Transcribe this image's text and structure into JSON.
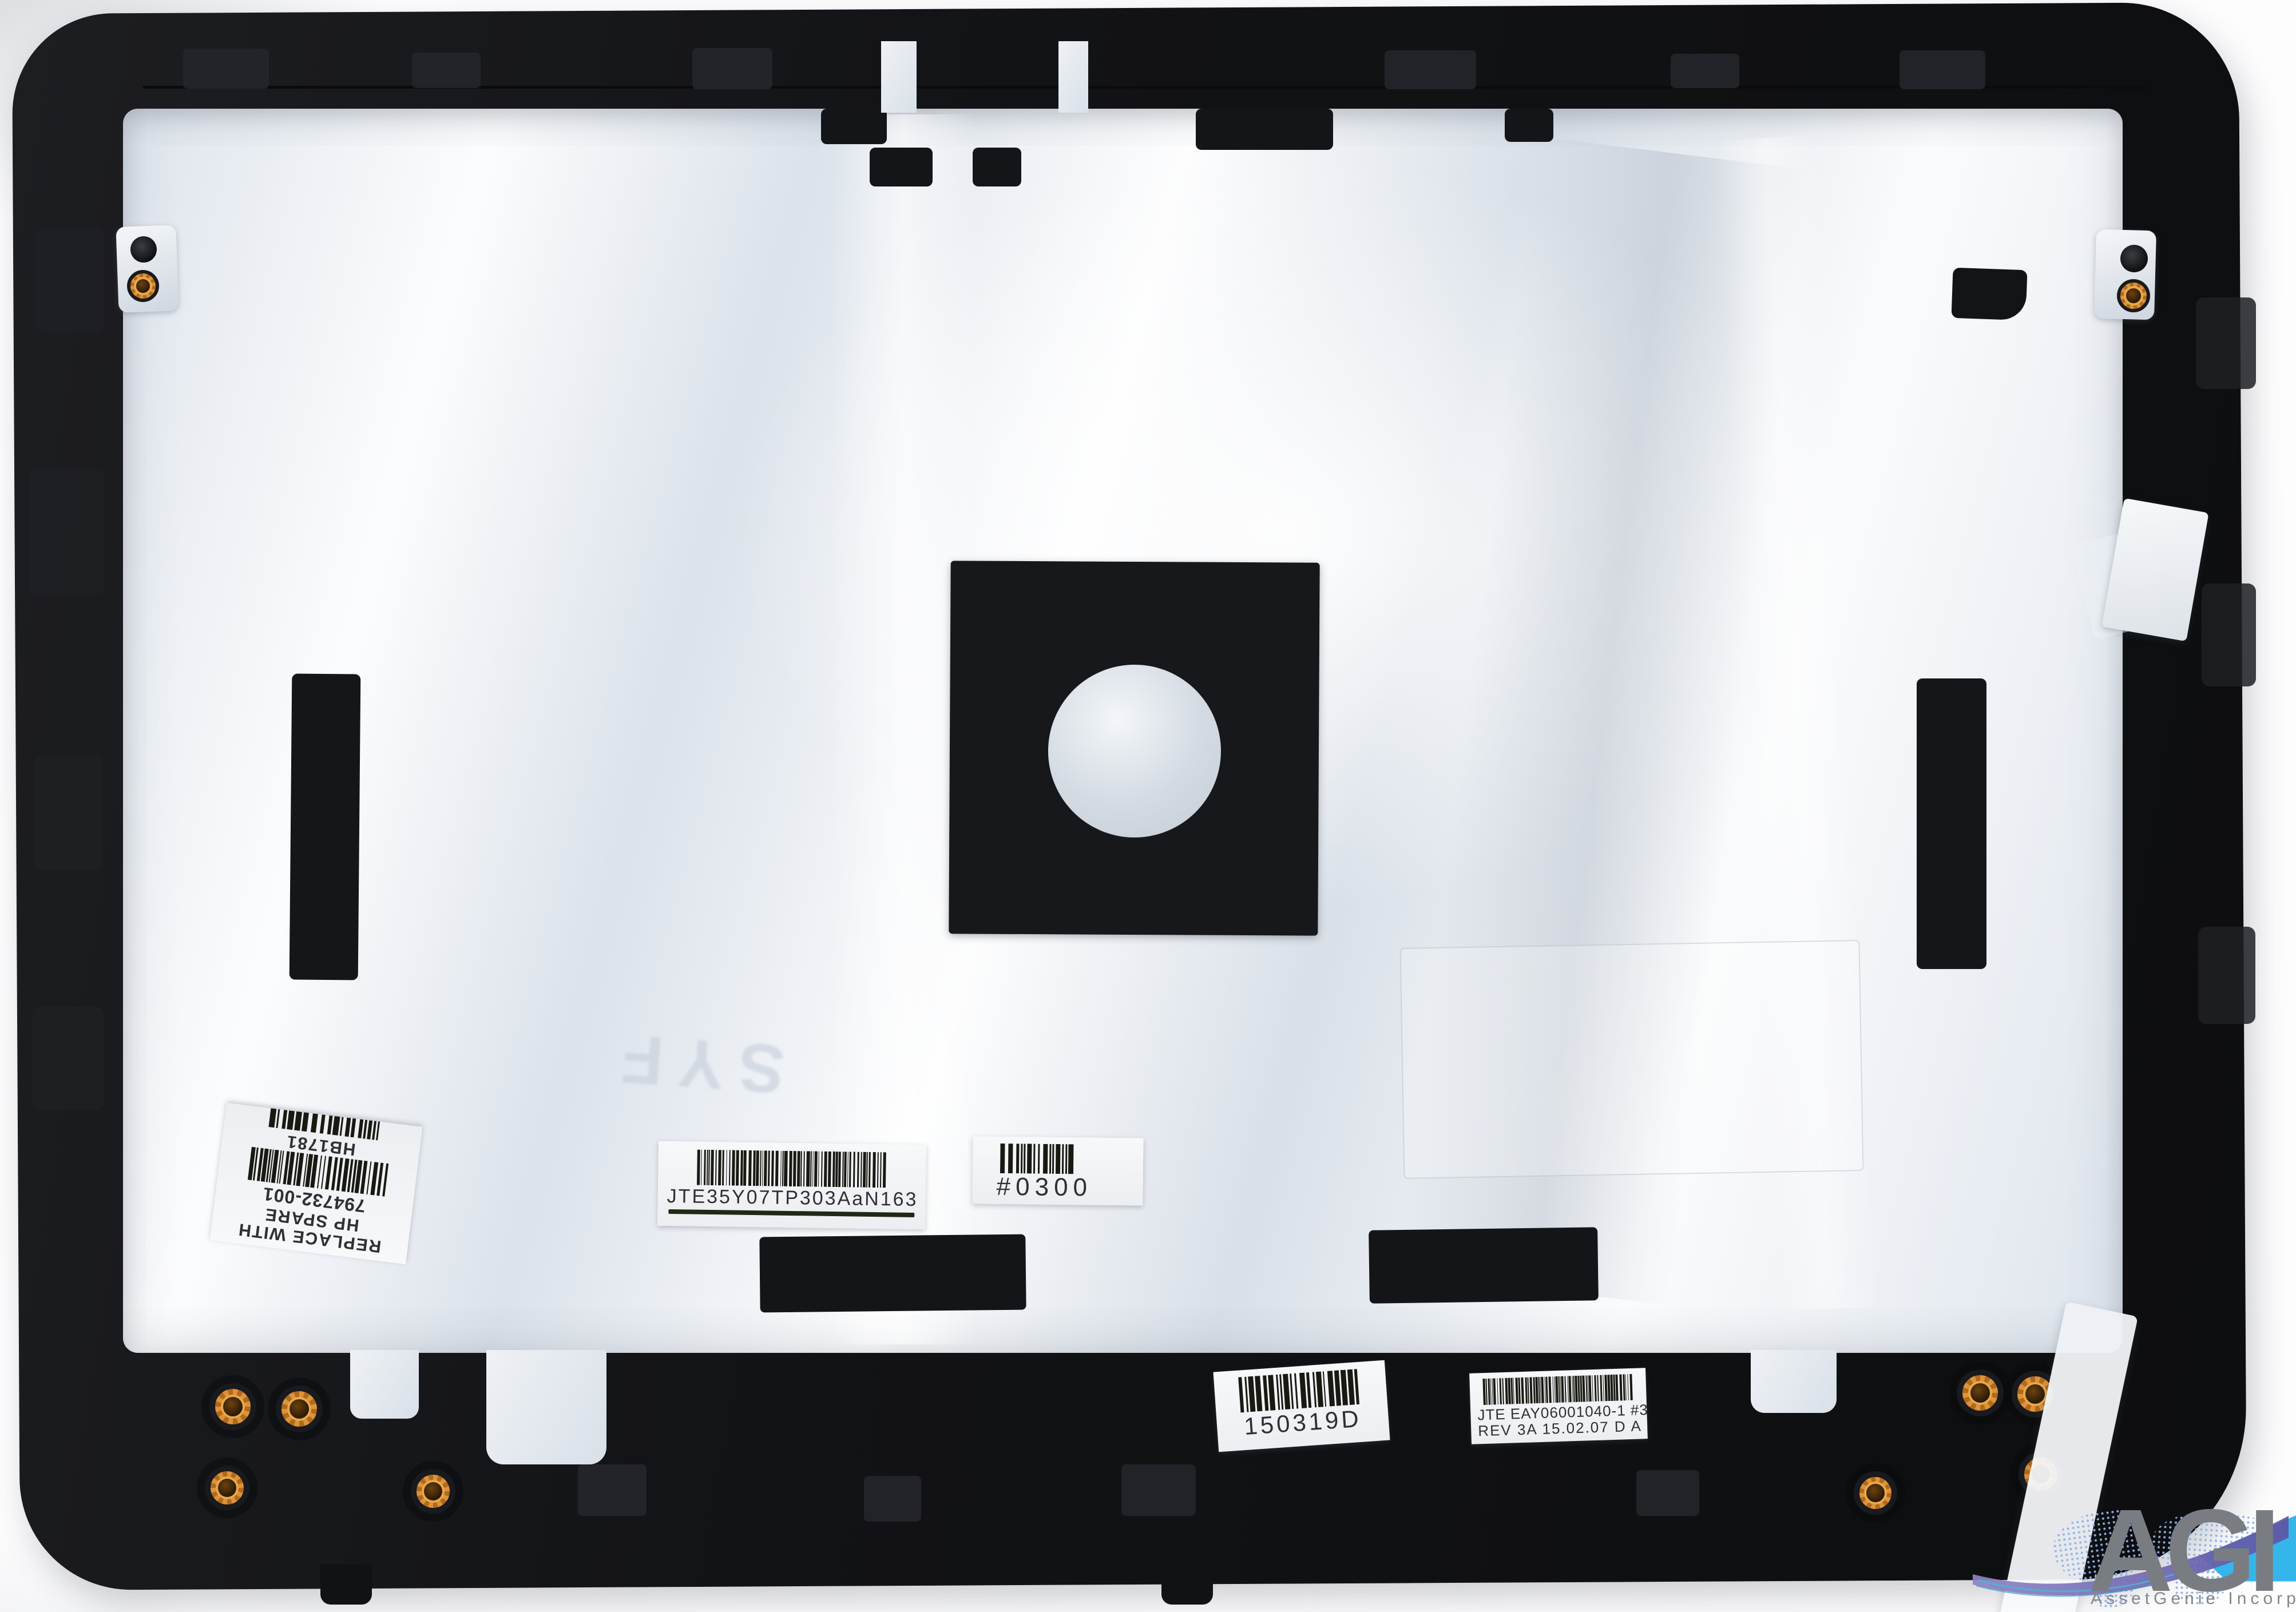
{
  "scene": {
    "background_color": "#fdfdfe",
    "plastic_color": "#131417",
    "foil_color": "#e7ecf2",
    "insert_orange": "#dd9338"
  },
  "labels": {
    "hp": {
      "line1": "REPLACE WITH",
      "line2": "HP SPARE",
      "part_number": "794732-001",
      "inventory_code": "HB1781"
    },
    "serial": {
      "code": "JTE35Y07TP303AaN163"
    },
    "config": {
      "code": "#0300"
    },
    "date": {
      "code": "150319D"
    },
    "rev": {
      "line1": "JTE EAY06001040-1 #3",
      "line2": "REV 3A 15.02.07 D A"
    }
  },
  "emboss": {
    "text": "SYF"
  },
  "watermark": {
    "acronym": "AGI",
    "company": "AssetGenie Incorporated",
    "accent_blue": "#35b6ea",
    "swoosh_purple": "#5d54a4",
    "map_dot_color": "#8fb3e8",
    "text_gray": "#797d82"
  }
}
